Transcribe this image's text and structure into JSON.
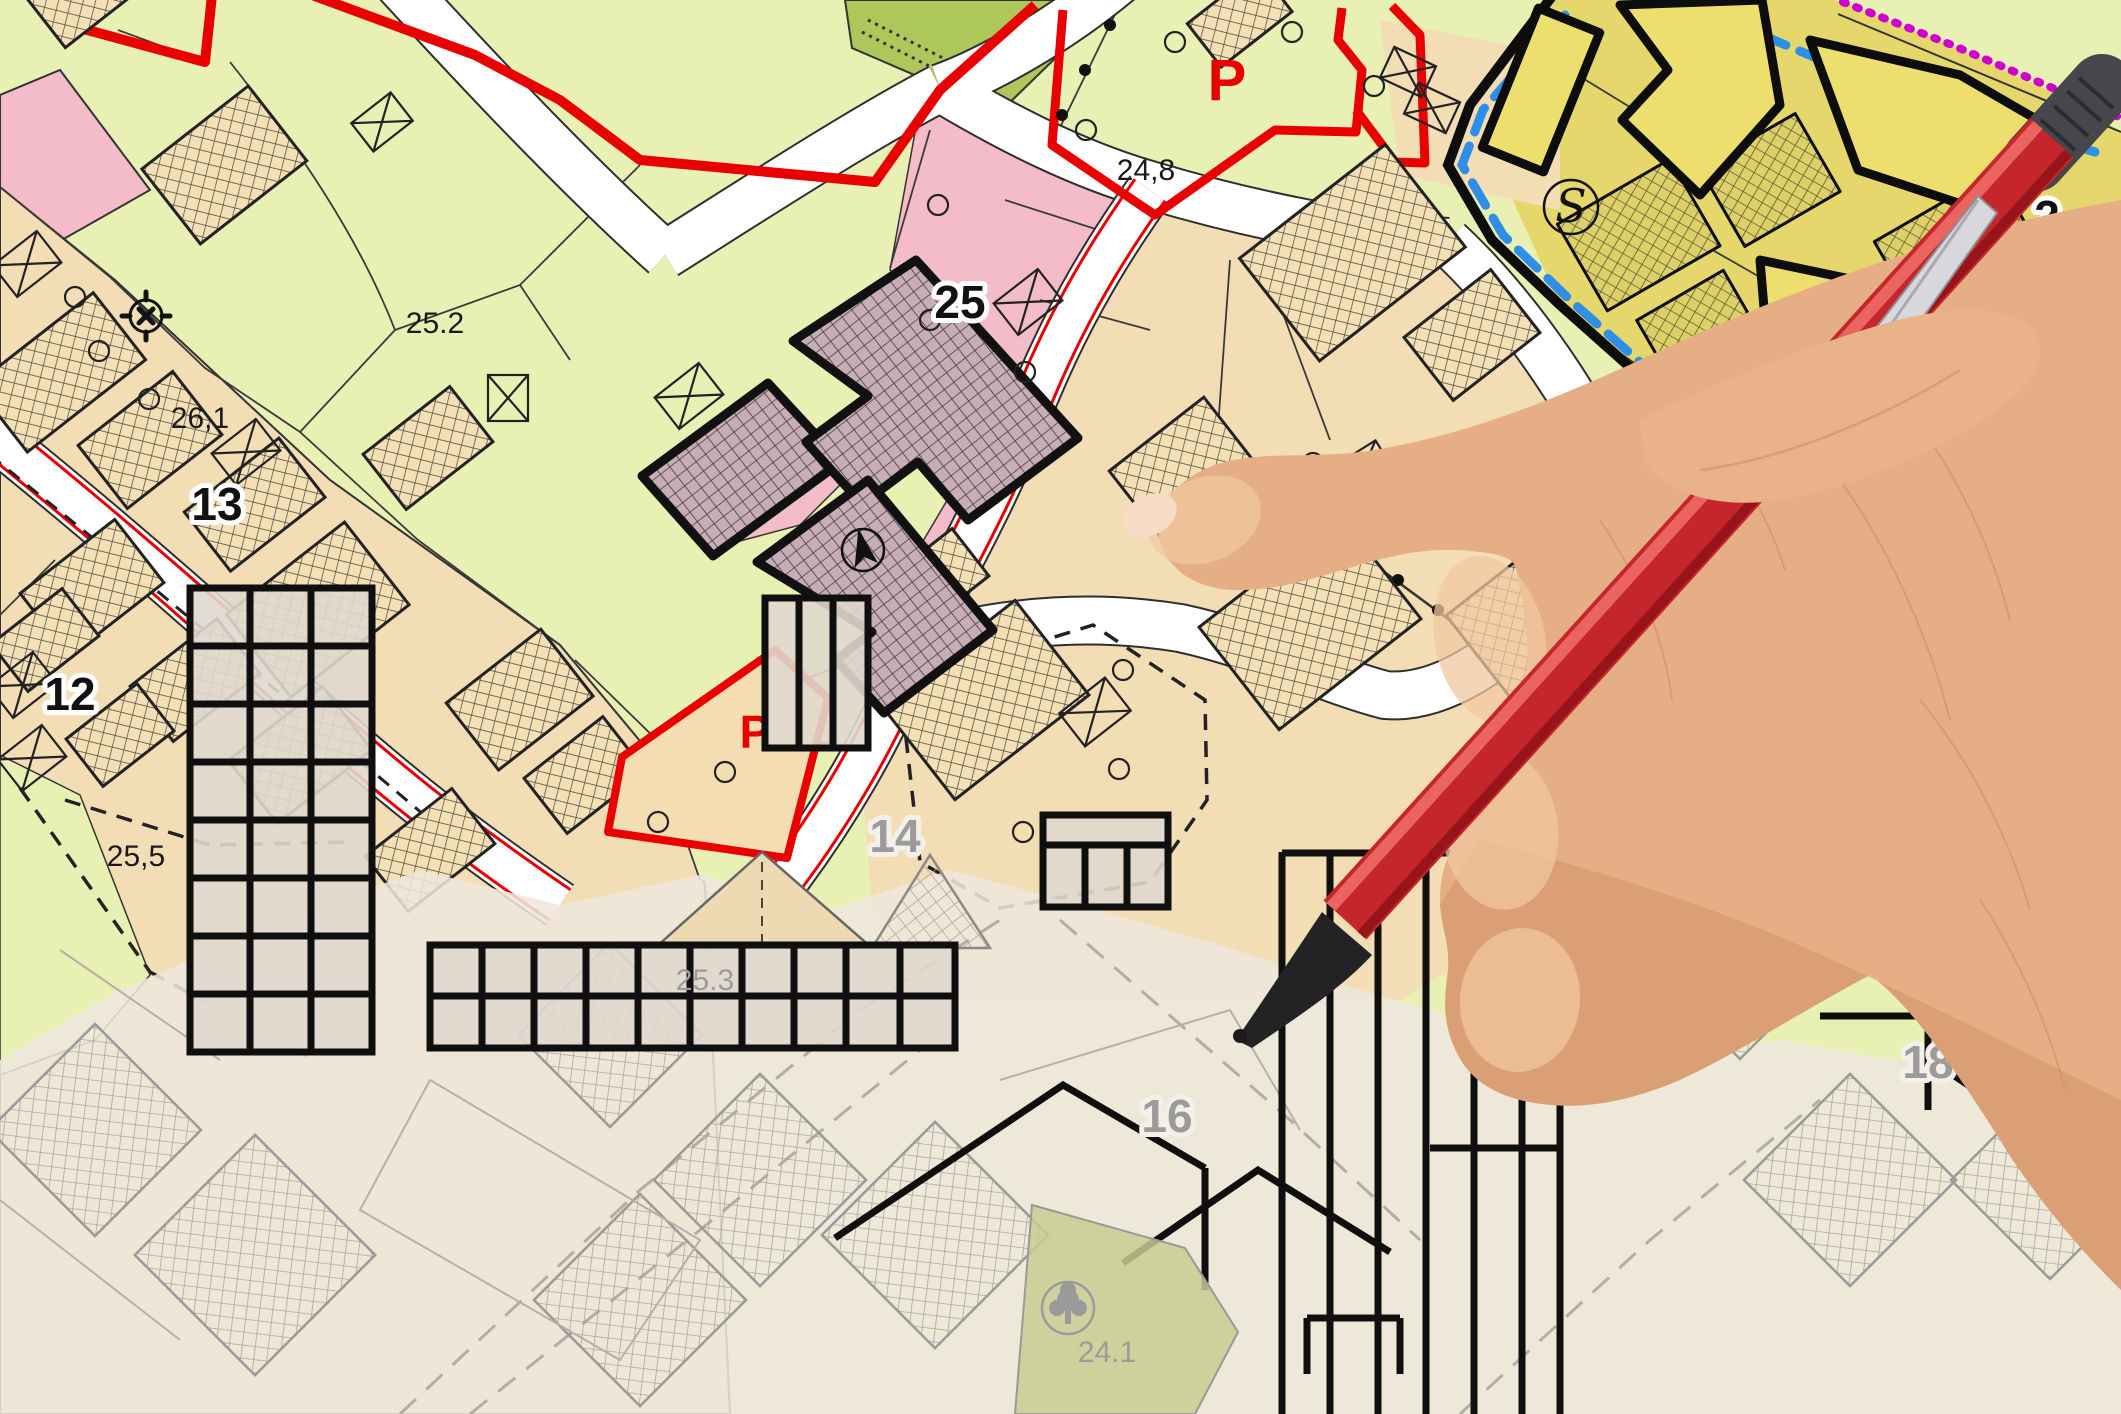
{
  "title": "general-urban-zoning-plan-with-hand-and-pencil",
  "map": {
    "labels": {
      "zone_25_2": "25.2",
      "zone_26_1": "26,1",
      "parcel_13": "13",
      "parcel_12": "12",
      "zone_25_5": "25,5",
      "parcel_25": "25",
      "parking_top": "P",
      "elev_24_8": "24,8",
      "parking_mid": "P",
      "zone_25_1": "25.1",
      "parcel_15": "15",
      "school_badge": "S",
      "partial_2": "2",
      "elev_4_8": "4,8",
      "sketch_14": "14",
      "sketch_25_3": "25.3",
      "sketch_16": "16",
      "sketch_24_1": "24.1",
      "sketch_18": "18"
    },
    "symbols": {
      "survey_marker": "crossed-circle-survey-marker",
      "north_arrow": "north-arrow",
      "school_circle": "circled-S-school-symbol",
      "tree": "tree-symbol",
      "crossed_box": "crossed-rectangle-symbol"
    },
    "colors": {
      "zone_green": "#e9f0b4",
      "zone_green_dark": "#aec75a",
      "zone_pink": "#f3bcc8",
      "zone_tan": "#f3ddb5",
      "zone_yellow": "#e5d76b",
      "building_mauve": "#c7adb6",
      "boundary_red": "#e90000",
      "boundary_blue": "#2f8fe8",
      "boundary_magenta": "#cf00cf",
      "road_white": "#ffffff",
      "sketch_grey": "#9a9a9a",
      "pen_red": "#c3242b",
      "skin": "#e7b18a"
    }
  }
}
